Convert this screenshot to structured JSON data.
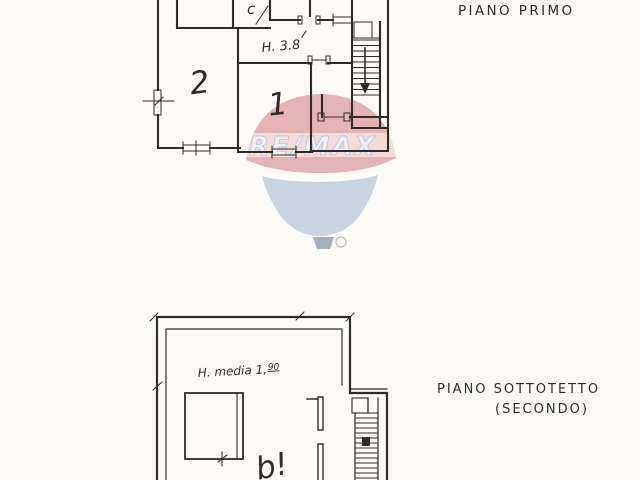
{
  "canvas": {
    "paper_color": "#fcfbf8",
    "ink_color": "#2e2c29"
  },
  "first_floor_plan": {
    "title": "PIANO PRIMO",
    "height_note": "H. 3.8",
    "room_labels": {
      "top_room": "c",
      "left_room": "2",
      "center_room": "1"
    }
  },
  "attic_plan": {
    "title_line1": "PIANO SOTTOTETTO",
    "title_line2": "(SECONDO)",
    "height_note_prefix": "H. media 1,",
    "height_note_sup": "90",
    "room_label": "b!"
  },
  "watermark": {
    "brand": "RE/MAX",
    "balloon_top_color": "#c84f55",
    "balloon_bottom_color": "#8fa2c3",
    "wordmark_color": "#eef2fa",
    "wordmark_outline": "#aebdd6",
    "basket_color": "#8a94a4"
  }
}
